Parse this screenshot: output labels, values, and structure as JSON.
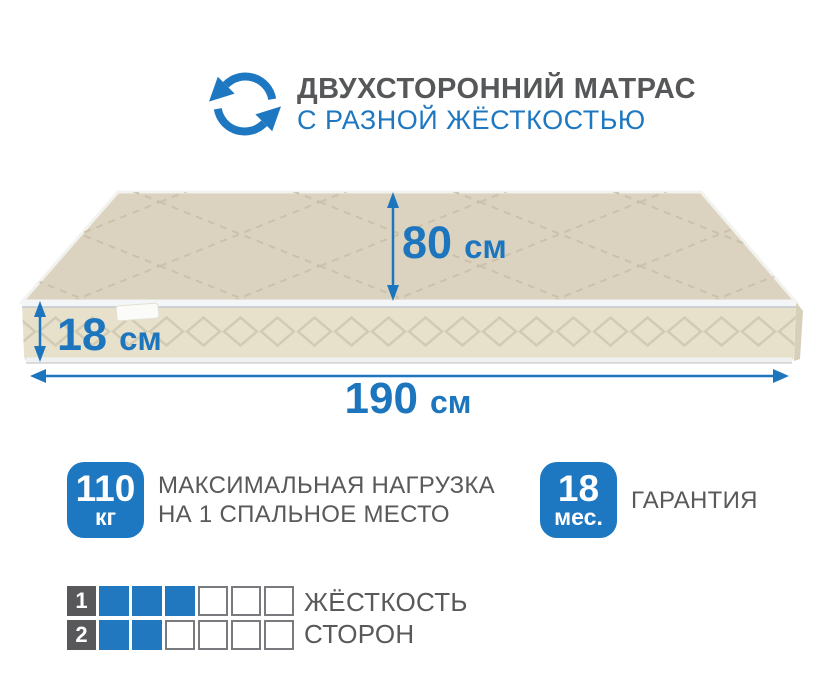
{
  "header": {
    "title": "ДВУХСТОРОННИЙ МАТРАС",
    "subtitle": "С РАЗНОЙ ЖЁСТКОСТЬЮ",
    "icon": "rotate-arrows-icon"
  },
  "dimensions": {
    "depth": {
      "value": "80",
      "unit": "см"
    },
    "height": {
      "value": "18",
      "unit": "см"
    },
    "width": {
      "value": "190",
      "unit": "см"
    }
  },
  "badges": [
    {
      "value": "110",
      "unit": "кг",
      "label_lines": [
        "МАКСИМАЛЬНАЯ НАГРУЗКА",
        "НА 1 СПАЛЬНОЕ МЕСТО"
      ]
    },
    {
      "value": "18",
      "unit": "мес.",
      "label_lines": [
        "ГАРАНТИЯ"
      ]
    }
  ],
  "firmness": {
    "label_lines": [
      "ЖЁСТКОСТЬ",
      "СТОРОН"
    ],
    "rows": [
      {
        "side": "1",
        "filled": 3,
        "total": 6
      },
      {
        "side": "2",
        "filled": 2,
        "total": 6
      }
    ]
  },
  "colors": {
    "accent_blue": "#1d78c1",
    "grid_filled_blue": "#2178bf",
    "text_gray": "#58595b",
    "grid_label_bg": "#58585a",
    "grid_empty_border": "#797a7d",
    "mattress_top": "#dbd3bf",
    "mattress_front": "#e7e1cc",
    "piping_white": "#f4f5f6"
  }
}
